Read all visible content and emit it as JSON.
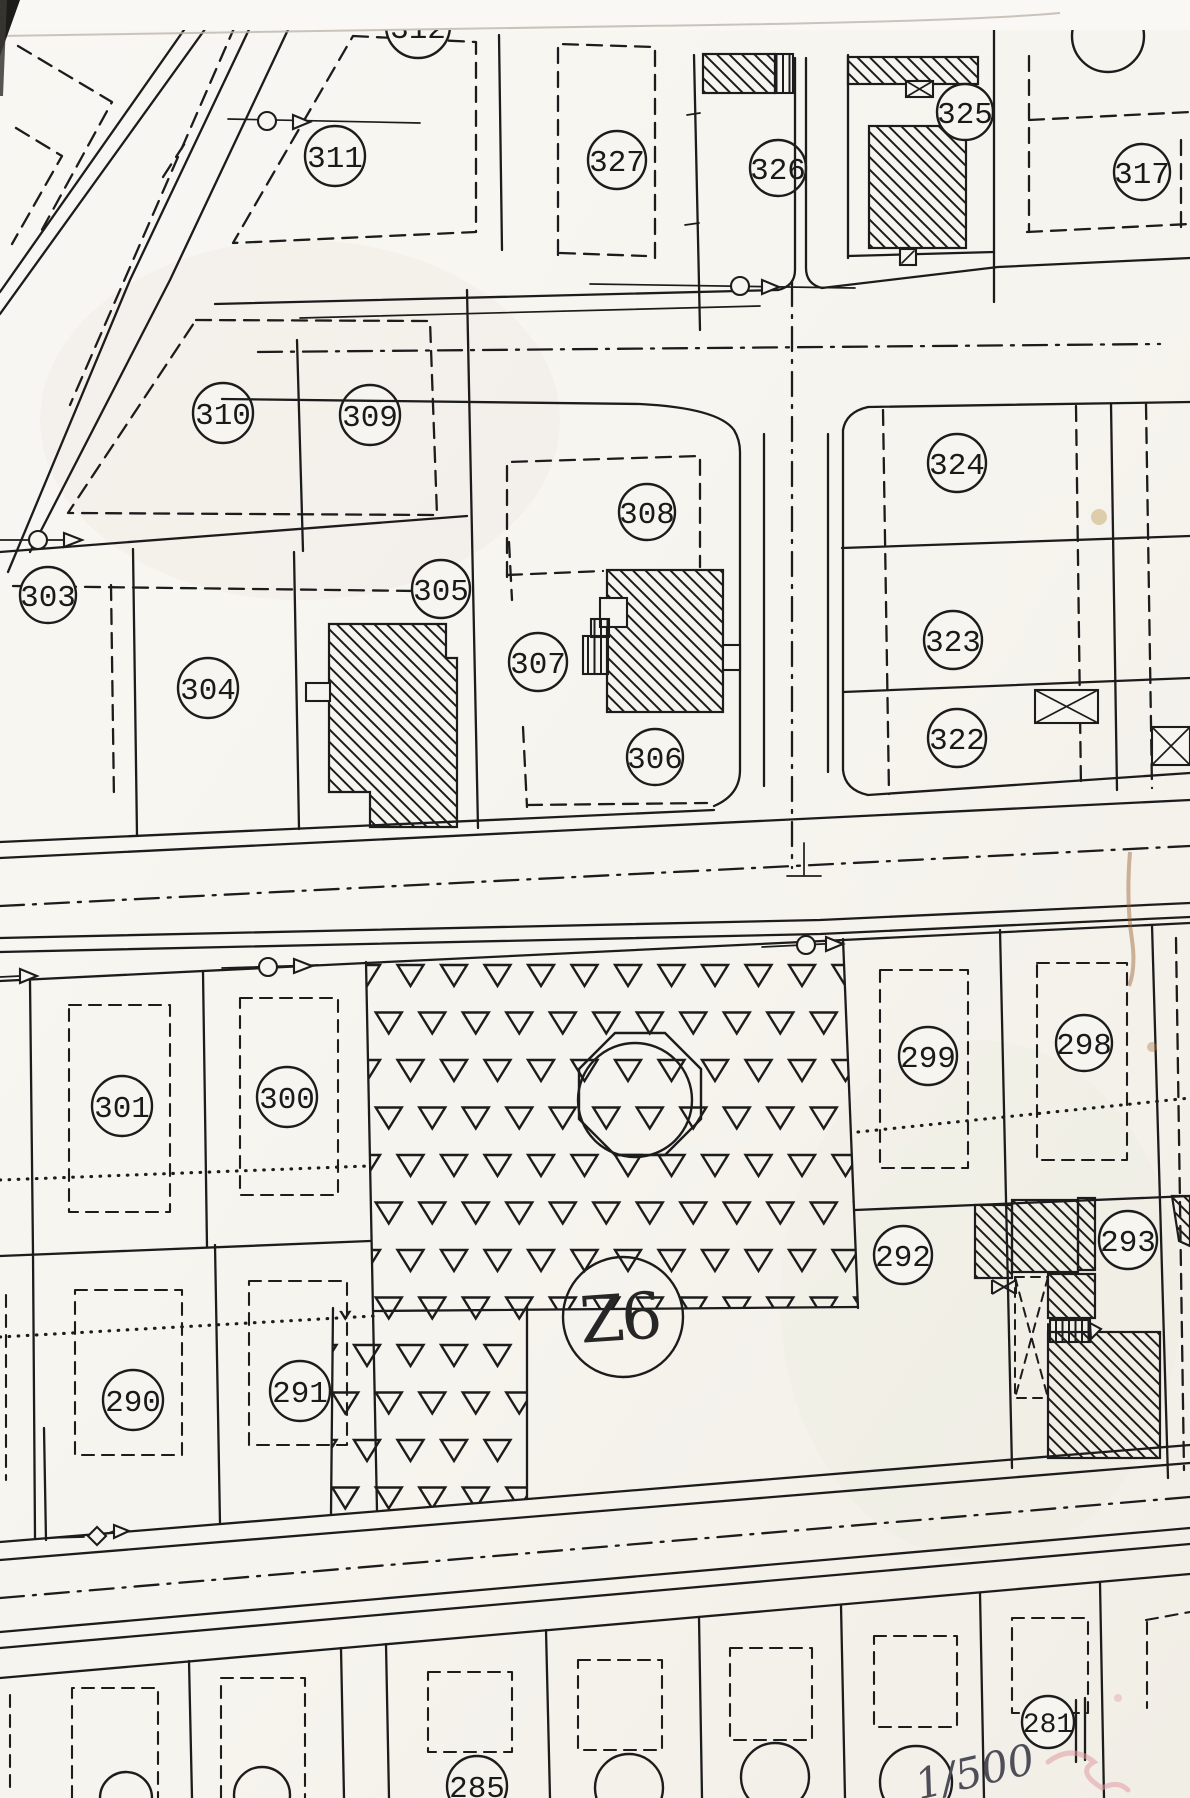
{
  "parcels": {
    "p281": "281",
    "p285": "285",
    "p290": "290",
    "p291": "291",
    "p292": "292",
    "p293": "293",
    "p298": "298",
    "p299": "299",
    "p300": "300",
    "p301": "301",
    "p303": "303",
    "p304": "304",
    "p305": "305",
    "p306": "306",
    "p307": "307",
    "p308": "308",
    "p309": "309",
    "p310": "310",
    "p311": "311",
    "p312": "312",
    "p317": "317",
    "p322": "322",
    "p323": "323",
    "p324": "324",
    "p325": "325",
    "p326": "326",
    "p327": "327"
  },
  "zone": {
    "label": "Z6"
  },
  "annotations": {
    "scale_handwritten": "1/500"
  },
  "colors": {
    "ink": "#1c1c1c",
    "paper": "#f7f5f0",
    "stain": "#9b5f2e",
    "pink_mark": "#e39aa4"
  }
}
